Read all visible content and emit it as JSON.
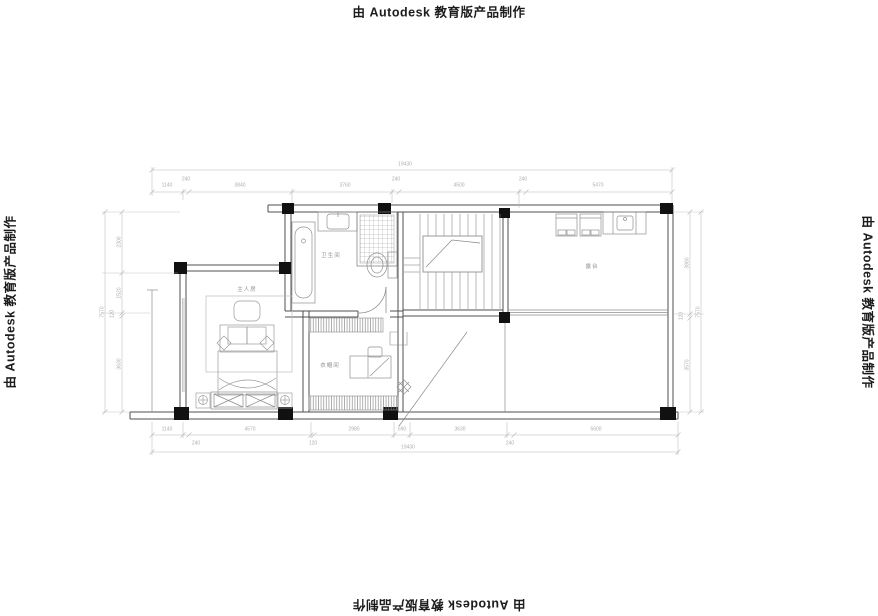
{
  "watermark": {
    "text": "由 Autodesk 教育版产品制作"
  },
  "rooms": {
    "master_bedroom": "主人房",
    "bathroom": "卫生间",
    "cloakroom": "衣帽间",
    "terrace": "露台"
  },
  "dims": {
    "top": {
      "total": "19430",
      "chain": [
        "1140",
        "240",
        "3840",
        "3760",
        "240",
        "4500",
        "240",
        "5470"
      ]
    },
    "bottom": {
      "total": "19430",
      "chain": [
        "1140",
        "240",
        "4570",
        "120",
        "2980",
        "590",
        "3630",
        "240",
        "5600"
      ]
    },
    "left": {
      "total": "7570",
      "chain": [
        "2300",
        "1520",
        "120",
        "3630"
      ]
    },
    "right": {
      "total": "7570",
      "chain": [
        "3880",
        "120",
        "3570"
      ]
    }
  },
  "colors": {
    "wall": "#4f4f4f",
    "column": "#111111",
    "furniture": "#909090",
    "dimension": "#b5b5b5",
    "watermark": "#1c1c1c"
  }
}
